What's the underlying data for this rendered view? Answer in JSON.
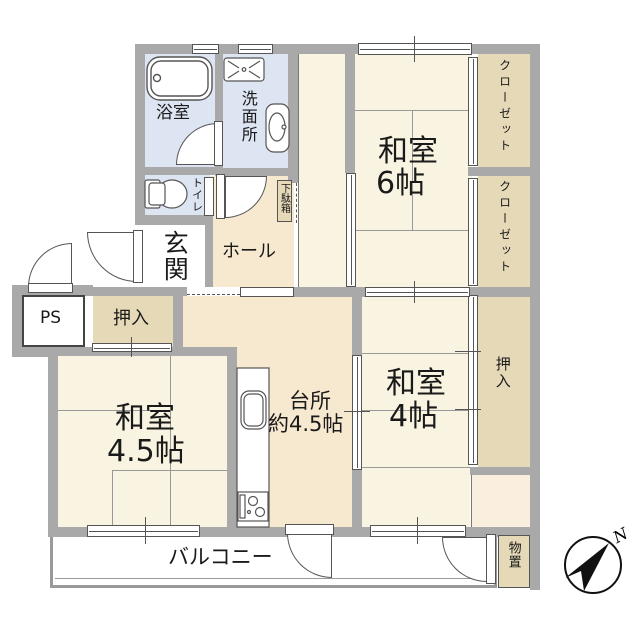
{
  "colors": {
    "wall": "#a9a9a9",
    "cream": "#f9f4e1",
    "peach": "#f7e8d0",
    "peach_light": "#faefdf",
    "tan": "#e5d9b8",
    "blue": "#dde4f2",
    "outline": "#555555",
    "line": "#999999",
    "text": "#1a1a1a"
  },
  "rooms": {
    "bath": {
      "label": "浴室"
    },
    "washroom": {
      "label": "洗面所"
    },
    "toilet": {
      "label": "トイレ"
    },
    "entrance": {
      "label": "玄関"
    },
    "hall": {
      "label": "ホール"
    },
    "shoe_cabinet": {
      "label": "下駄箱"
    },
    "ps": {
      "label": "PS"
    },
    "oshiire_left": {
      "label": "押入"
    },
    "washitsu_6": {
      "label": "和室",
      "size": "6帖"
    },
    "closet_upper": {
      "label": "クローゼット"
    },
    "closet_lower": {
      "label": "クローゼット"
    },
    "washitsu_45": {
      "label": "和室",
      "size": "4.5帖"
    },
    "kitchen": {
      "label": "台所",
      "size": "約4.5帖"
    },
    "washitsu_4": {
      "label": "和室",
      "size": "4帖"
    },
    "oshiire_right": {
      "label": "押入"
    },
    "storage": {
      "label": "物置"
    },
    "balcony": {
      "label": "バルコニー"
    }
  },
  "compass": {
    "north_label": "N"
  }
}
